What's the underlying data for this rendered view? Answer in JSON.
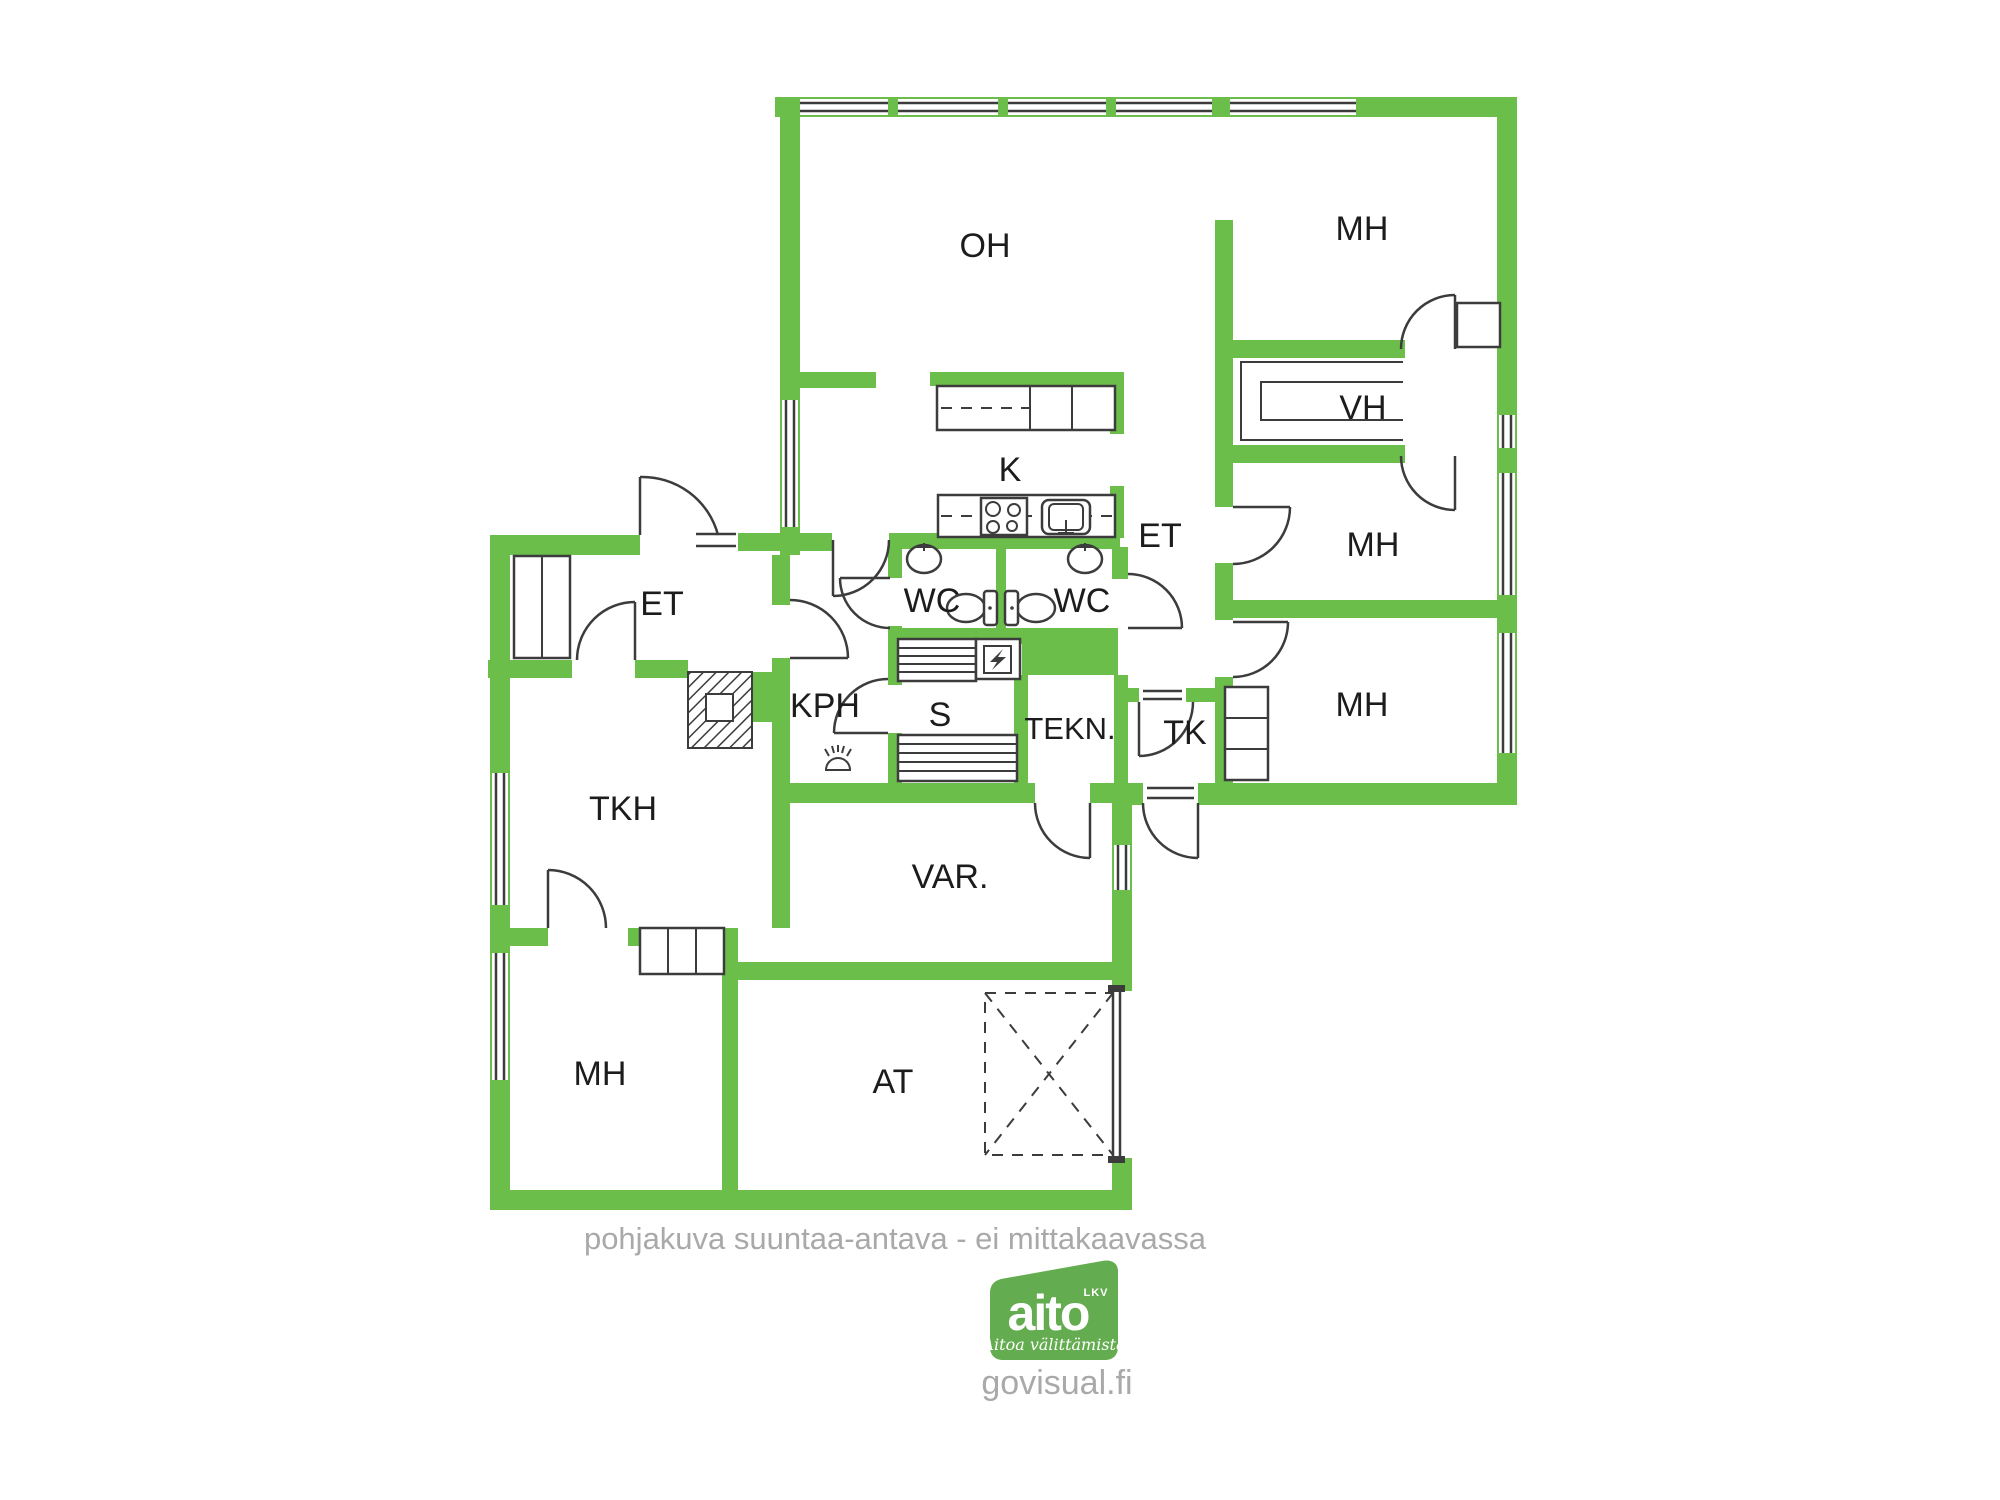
{
  "colors": {
    "wall_green": "#6CBE4B",
    "logo_green": "#64AC50",
    "muted_gray": "#A9A9A9",
    "line_dark": "#3C3C3C"
  },
  "rooms": [
    {
      "id": "oh",
      "label": "OH"
    },
    {
      "id": "mh-top",
      "label": "MH"
    },
    {
      "id": "vh",
      "label": "VH"
    },
    {
      "id": "mh-mid",
      "label": "MH"
    },
    {
      "id": "et-right",
      "label": "ET"
    },
    {
      "id": "mh-low",
      "label": "MH"
    },
    {
      "id": "tk",
      "label": "TK"
    },
    {
      "id": "tekn",
      "label": "TEKN."
    },
    {
      "id": "sauna",
      "label": "S"
    },
    {
      "id": "kph",
      "label": "KPH"
    },
    {
      "id": "k",
      "label": "K"
    },
    {
      "id": "wc-left",
      "label": "WC"
    },
    {
      "id": "wc-right",
      "label": "WC"
    },
    {
      "id": "et-left",
      "label": "ET"
    },
    {
      "id": "tkh",
      "label": "TKH"
    },
    {
      "id": "var",
      "label": "VAR."
    },
    {
      "id": "mh-bl",
      "label": "MH"
    },
    {
      "id": "at",
      "label": "AT"
    }
  ],
  "footer": {
    "disclaimer": "pohjakuva suuntaa-antava - ei mittakaavassa",
    "website": "govisual.fi"
  },
  "logo": {
    "brand": "aito",
    "suffix": "LKV",
    "tagline": "Aitoa välittämistä"
  }
}
